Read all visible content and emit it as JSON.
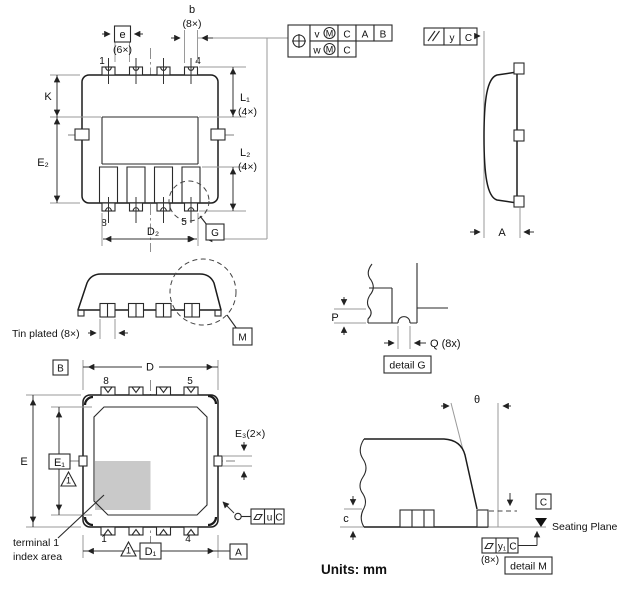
{
  "units_label": "Units: mm",
  "top_view": {
    "dim_b": "b",
    "dim_b_qty": "(8×)",
    "dim_e": "e",
    "dim_e_qty": "(6×)",
    "pin1": "1",
    "pin4": "4",
    "pin8": "8",
    "pin5": "5",
    "dim_k": "K",
    "dim_e2": "E₂",
    "dim_l1": "L₁",
    "dim_l1_qty": "(4×)",
    "dim_l2": "L₂",
    "dim_l2_qty": "(4×)",
    "dim_d2": "D₂",
    "detail_ref_g": "G"
  },
  "frames": {
    "position": {
      "row1": {
        "t": "v",
        "mod": "M",
        "datum1": "C",
        "datum2": "A",
        "datum3": "B"
      },
      "row2": {
        "t": "w",
        "mod": "M",
        "datum1": "C"
      }
    },
    "parallelism": {
      "t": "y",
      "datum": "C"
    },
    "flatness_u": {
      "t": "u",
      "datum": "C"
    },
    "flatness_y1": {
      "t": "y₁",
      "datum": "C",
      "qty": "(8×)"
    }
  },
  "side_view": {
    "dim_a": "A"
  },
  "side_elevation": {
    "tin_plated": "Tin plated (8×)",
    "detail_ref_m": "M"
  },
  "detail_g": {
    "dim_p": "P",
    "dim_q": "Q (8x)",
    "caption": "detail G"
  },
  "bottom_view": {
    "datum_b": "B",
    "datum_a": "A",
    "dim_d": "D",
    "dim_d1": "D₁",
    "dim_e": "E",
    "dim_e1": "E₁",
    "dim_e3": "E₃(2×)",
    "pin8": "8",
    "pin5": "5",
    "pin1": "1",
    "pin4": "4",
    "note1": "1",
    "terminal_note_line1": "terminal 1",
    "terminal_note_line2": "index area"
  },
  "detail_m": {
    "theta": "θ",
    "dim_c": "c",
    "seating_plane": "Seating Plane",
    "datum_c": "C",
    "qty": "(8×)",
    "caption": "detail M"
  },
  "colors": {
    "line": "#1c1c1c",
    "extension": "#9a9a9a",
    "index_area": "#c9c9c9"
  }
}
